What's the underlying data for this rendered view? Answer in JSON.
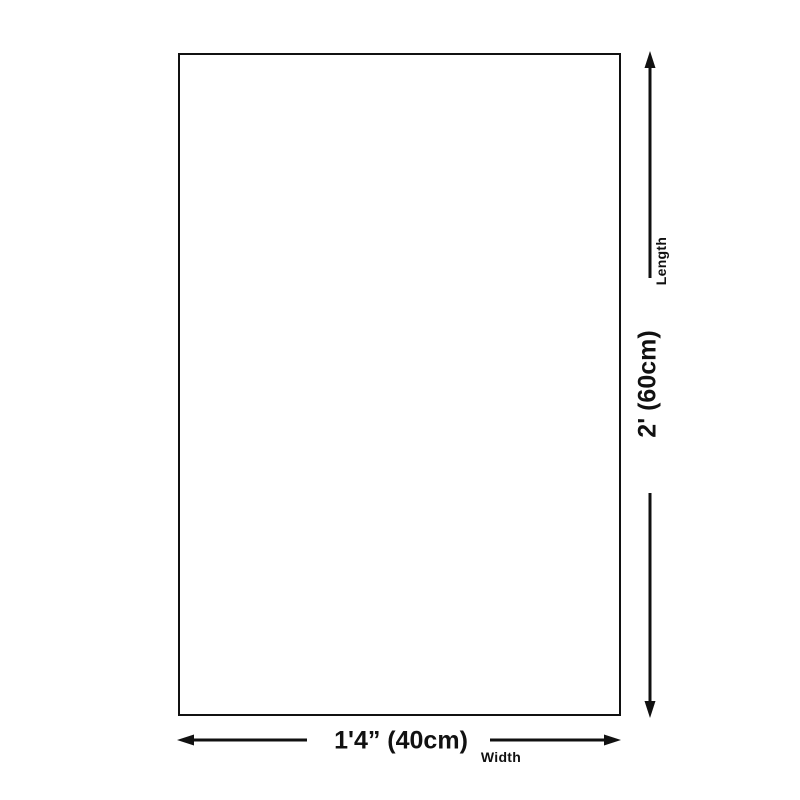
{
  "diagram": {
    "type": "product-dimension-diagram",
    "background_color": "#ffffff",
    "line_color": "#111111",
    "shape": "rectangle",
    "length": {
      "value": "2' (60cm)",
      "label": "Length",
      "orientation": "vertical"
    },
    "width": {
      "value": "1'4” (40cm)",
      "label": "Width",
      "orientation": "horizontal"
    }
  }
}
